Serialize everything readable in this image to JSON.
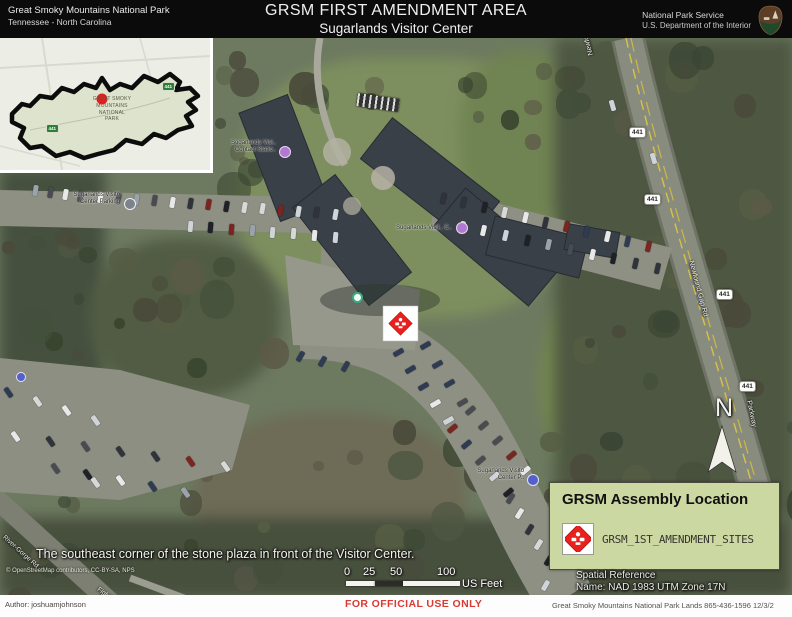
{
  "header": {
    "park_name": "Great Smoky Mountains National Park",
    "states": "Tennessee  -  North Carolina",
    "title": "GRSM FIRST AMENDMENT AREA",
    "subtitle": "Sugarlands Visitor Center",
    "agency_line1": "National Park Service",
    "agency_line2": "U.S. Department of the Interior"
  },
  "inset": {
    "park_line1": "GREAT SMOKY",
    "park_line2": "MOUNTAINS",
    "park_line3": "NATIONAL",
    "park_line4": "PARK",
    "shield_a": "441",
    "shield_b": "441"
  },
  "map": {
    "caption": "The southeast corner of the stone plaza in front of the Visitor Center.",
    "north": "N",
    "attribution": "© OpenStreetMap contributors, CC-BY-SA, NPS",
    "shield": "441",
    "roads": {
      "newfound_top": "Newfound Gap Rd",
      "newfound_mid": "Newfound Gap Rd",
      "parkway": "Parkway",
      "gorge": "River-Gorge Rd",
      "fighting": "Fighting Cr"
    },
    "poi": {
      "parking_1": "Sugarlands Visito",
      "parking_2": "Center Parking",
      "contact_1": "Sugarlands Visi..",
      "contact_2": "Contact Statio..",
      "vc_1": "Sugarlands Visit.. C..",
      "south_1": "Sugarlands Visito",
      "south_2": "Center P.."
    }
  },
  "scalebar": {
    "t0": "0",
    "t25": "25",
    "t50": "50",
    "t100": "100",
    "unit": "US Feet"
  },
  "spatial": {
    "line1": "Spatial Reference",
    "line2": "Name: NAD 1983 UTM Zone 17N"
  },
  "legend": {
    "title": "GRSM Assembly Location",
    "item": "GRSM_1ST_AMENDMENT_SITES"
  },
  "footer": {
    "author": "Author: joshuamjohnson",
    "official": "FOR OFFICIAL USE ONLY",
    "contact": "Great Smoky Mountains National Park Lands 865-436-1596 12/3/2"
  },
  "colors": {
    "legend_bg": "#ccd8a2",
    "diamond_red": "#e8211d",
    "official_red": "#d93a32"
  }
}
